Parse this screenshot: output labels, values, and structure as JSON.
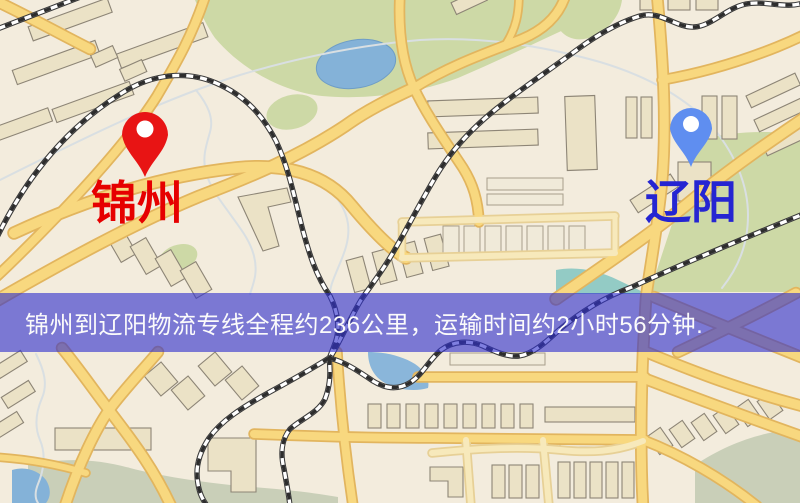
{
  "banner": {
    "text": "锦州到辽阳物流专线全程约236公里，运输时间约2小时56分钟.",
    "distance_text": "236公里",
    "duration_text": "2小时56分钟",
    "background_rgba": "rgba(48,48,205,0.62)",
    "text_color": "#fbfbfb"
  },
  "markers": {
    "origin": {
      "name": "锦州",
      "label_color": "#e60000",
      "pin_color": "#e81414"
    },
    "destination": {
      "name": "辽阳",
      "label_color": "#2525d2",
      "pin_color": "#5f8ef0"
    }
  }
}
